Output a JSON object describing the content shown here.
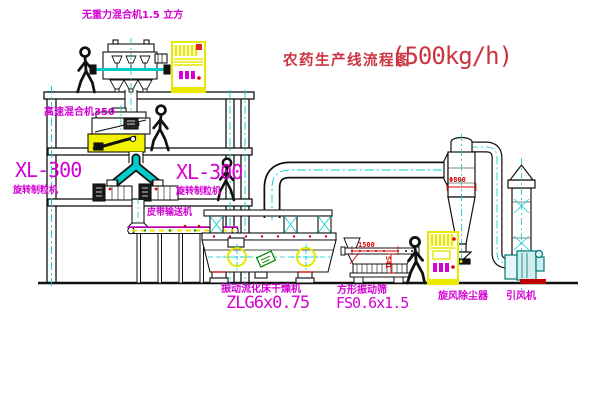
{
  "title": {
    "cn": "农药生产线流程图",
    "capacity": "(500kg/h)"
  },
  "labels": {
    "mixer_top": "无重力混合机1.5 立方",
    "mixer_floor2": "高速混合机350",
    "granulator1_model": "XL-300",
    "granulator1_name": "旋转制粒机",
    "granulator2_model": "XL-300",
    "granulator2_name": "旋转制粒机",
    "belt_conveyor": "皮带输送机",
    "dryer_name": "振动流化床干燥机",
    "dryer_model": "ZLG6x0.75",
    "sieve_name": "方形振动筛",
    "sieve_model": "FS0.6x1.5",
    "cyclone": "旋风除尘器",
    "fan": "引风机"
  },
  "dimensions": {
    "sieve_width": "1500",
    "sieve_height": "541",
    "cyclone_dia": "Φ800"
  },
  "colors": {
    "label_magenta": "#d400d4",
    "title_red": "#cc3340",
    "dimension_red": "#dd0000",
    "centerline_cyan": "#00cccc",
    "highlight_yellow": "#e8e800",
    "fan_teal": "#007878",
    "sticker_green": "#008000",
    "line_black": "#111111",
    "background": "#ffffff"
  }
}
